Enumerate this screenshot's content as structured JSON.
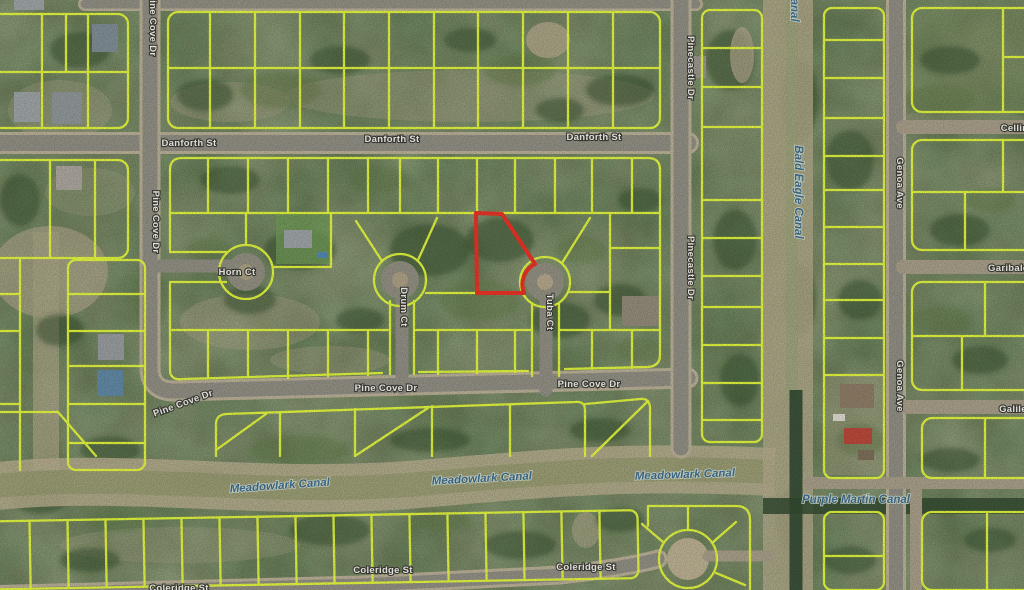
{
  "map_type": "satellite-parcel-map",
  "streets": {
    "danforth": "Danforth St",
    "pine_cove": "Pine Cove Dr",
    "horn": "Horn Ct",
    "drum": "Drum Ct",
    "tuba": "Tuba Ct",
    "pinecastle": "Pinecastle Dr",
    "genoa": "Genoa Ave",
    "cellini": "Cellini",
    "garibaldi": "Garibaldi",
    "galileo": "Galileo",
    "coleridge": "Coleridge St"
  },
  "canals": {
    "meadowlark": "Meadowlark Canal",
    "bald_eagle": "Bald Eagle Canal",
    "bald_eagle_partial": "Canal",
    "purple_martin": "Purple Martin Canal"
  },
  "highlight_parcel": {
    "outline_color": "#e53125"
  },
  "colors": {
    "parcel_line": "#e3f63b",
    "road": "#8e8c81",
    "street_label": "#f0efe9",
    "canal_label": "#3e6b8c"
  }
}
